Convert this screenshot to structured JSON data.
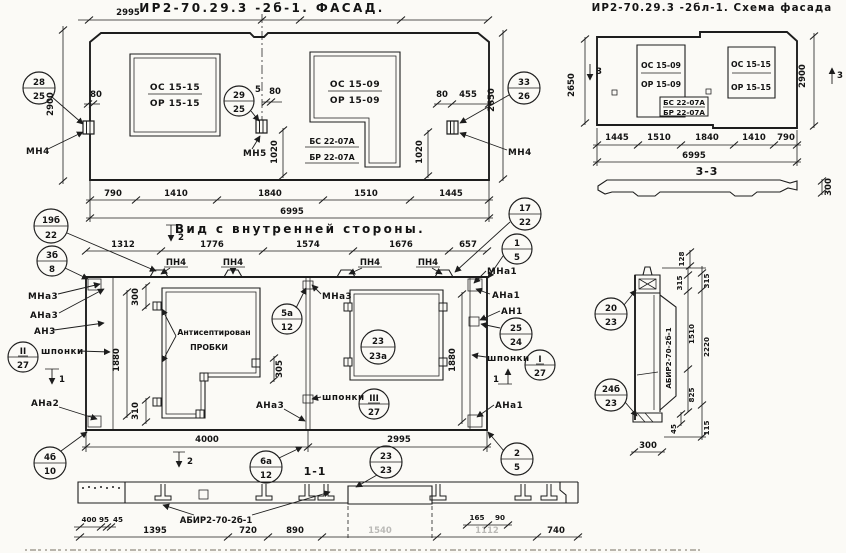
{
  "titles": {
    "facade": "ИР2-70.29.3 -2б-1. ФАСАД.",
    "schema": "ИР2-70.29.3 -2бл-1. Схема фасада",
    "inner": "Вид с внутренней стороны.",
    "s11": "1-1",
    "s33": "3-3"
  },
  "windows": {
    "os1515": "ОС 15-15",
    "or1515": "ОР 15-15",
    "os1509": "ОС 15-09",
    "or1509": "ОР 15-09",
    "bs": "БС 22-07А",
    "br": "БР 22-07А"
  },
  "labels": {
    "mn4": "МН4",
    "mn5": "МН5",
    "pn4": "ПН4",
    "mna3": "МНа3",
    "ana3": "АНа3",
    "an3": "АН3",
    "ana2": "АНа2",
    "mna1": "МНа1",
    "ana1": "АНа1",
    "an1": "АН1",
    "shponki": "шпонки",
    "anti1": "Антисептирован",
    "anti2": "ПРОБКИ",
    "abir": "АБИР2-70-2б-1"
  },
  "markers": {
    "m1": "1",
    "m2": "2",
    "m3": "3"
  },
  "callouts": {
    "c28": {
      "t": "28",
      "b": "25"
    },
    "c29": {
      "t": "29",
      "b": "25"
    },
    "c33": {
      "t": "33",
      "b": "26"
    },
    "c19b": {
      "t": "19б",
      "b": "22"
    },
    "c3b": {
      "t": "3б",
      "b": "8"
    },
    "cII": {
      "t": "II",
      "b": "27"
    },
    "c4b": {
      "t": "4б",
      "b": "10"
    },
    "c5a": {
      "t": "5а",
      "b": "12"
    },
    "c23a": {
      "t": "23",
      "b": "23а"
    },
    "cIII": {
      "t": "III",
      "b": "27"
    },
    "c17": {
      "t": "17",
      "b": "22"
    },
    "c1": {
      "t": "1",
      "b": "5"
    },
    "c25": {
      "t": "25",
      "b": "24"
    },
    "cI": {
      "t": "I",
      "b": "27"
    },
    "c2": {
      "t": "2",
      "b": "5"
    },
    "c6a": {
      "t": "6а",
      "b": "12"
    },
    "c23": {
      "t": "23",
      "b": "23"
    },
    "c20": {
      "t": "20",
      "b": "23"
    },
    "c24b": {
      "t": "24б",
      "b": "23"
    }
  },
  "dims": {
    "d2995": "2995",
    "d790": "790",
    "d1410": "1410",
    "d1840": "1840",
    "d1510": "1510",
    "d1445": "1445",
    "d6995": "6995",
    "d2900": "2900",
    "d2650": "2650",
    "d80": "80",
    "d455": "455",
    "d5": "5",
    "d1020": "1020",
    "d1312": "1312",
    "d1776": "1776",
    "d1574": "1574",
    "d1676": "1676",
    "d657": "657",
    "d4000": "4000",
    "d1880": "1880",
    "d300": "300",
    "d310": "310",
    "d305": "305",
    "d400": "400",
    "d95": "95",
    "d45": "45",
    "d1395": "1395",
    "d720": "720",
    "d890": "890",
    "d740": "740",
    "d165": "165",
    "d90": "90",
    "f1": "1540",
    "f2": "1112",
    "d128": "128",
    "d315": "315",
    "d2220": "2220",
    "d825": "825",
    "d115": "115"
  }
}
